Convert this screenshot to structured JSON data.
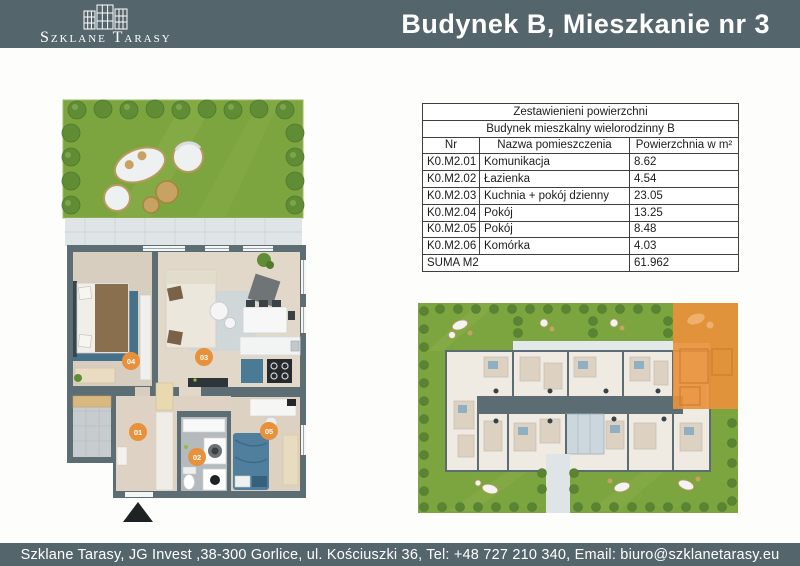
{
  "header": {
    "brand": "Szklane Tarasy",
    "title": "Budynek B, Mieszkanie nr 3"
  },
  "table": {
    "title": "Zestawienieni powierzchni",
    "subtitle": "Budynek mieszkalny wielorodzinny B",
    "columns": {
      "nr": "Nr",
      "name": "Nazwa pomieszczenia",
      "area": "Powierzchnia w m²"
    },
    "rows": [
      {
        "nr": "K0.M2.01",
        "name": "Komunikacja",
        "area": "8.62"
      },
      {
        "nr": "K0.M2.02",
        "name": "Łazienka",
        "area": "4.54"
      },
      {
        "nr": "K0.M2.03",
        "name": "Kuchnia + pokój dzienny",
        "area": "23.05"
      },
      {
        "nr": "K0.M2.04",
        "name": "Pokój",
        "area": "13.25"
      },
      {
        "nr": "K0.M2.05",
        "name": "Pokój",
        "area": "8.48"
      },
      {
        "nr": "K0.M2.06",
        "name": "Komórka",
        "area": "4.03"
      }
    ],
    "sum_label": "SUMA M2",
    "sum_value": "61.962"
  },
  "floor_plan": {
    "labels": [
      "01",
      "02",
      "03",
      "04",
      "05"
    ],
    "label_color": "#e8913a"
  },
  "site_plan": {
    "highlight_color": "#e8913a"
  },
  "footer": {
    "text": "Szklane Tarasy, JG Invest ,38-300 Gorlice, ul. Kościuszki 36, Tel: +48 727 210 340, Email: biuro@szklanetarasy.eu"
  },
  "colors": {
    "header_bar": "#55656c",
    "accent_orange": "#e8913a",
    "wall": "#5d6d74",
    "garden_green": "#7ca43f"
  }
}
